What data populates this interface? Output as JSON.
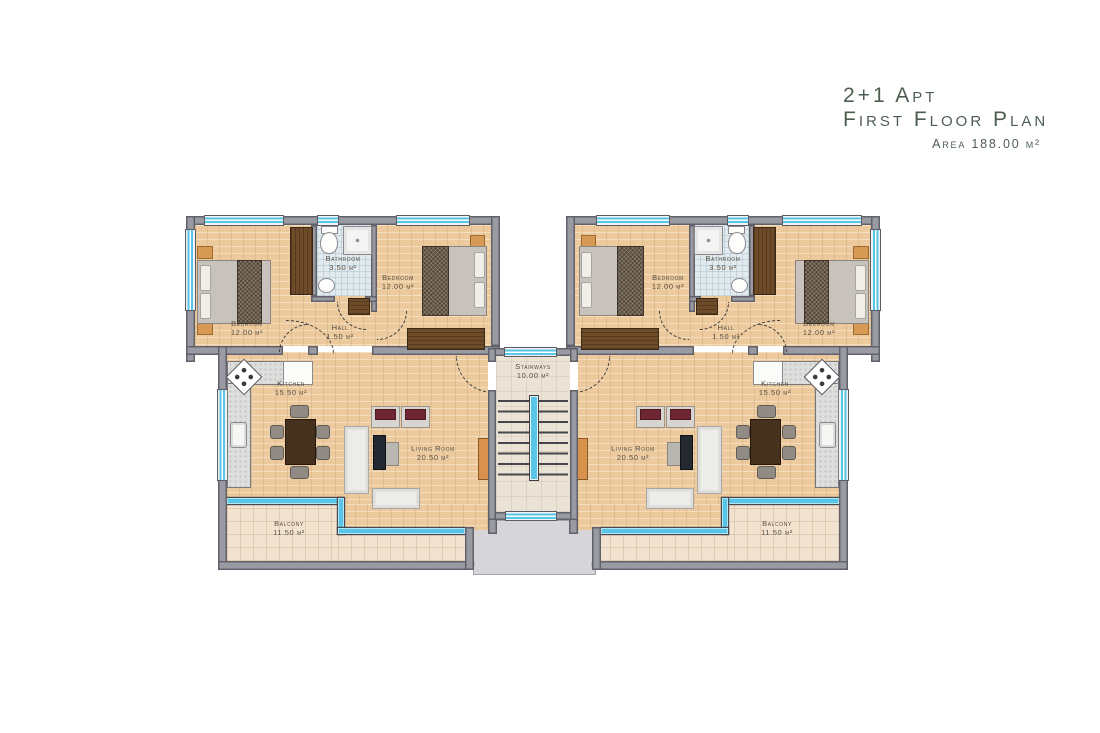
{
  "title": {
    "apt_type": "2+1 Apt",
    "plan_name": "First Floor Plan",
    "area_note": "Area 188.00 m²"
  },
  "rooms": {
    "bedroom": {
      "name": "Bedroom",
      "area": "12.00 m²"
    },
    "bathroom": {
      "name": "Bathroom",
      "area": "3.50 m²"
    },
    "hall": {
      "name": "Hall",
      "area": "1.50 m²"
    },
    "kitchen": {
      "name": "Kitchen",
      "area": "15.50 m²"
    },
    "living_room": {
      "name": "Living Room",
      "area": "20.50 m²"
    },
    "balcony": {
      "name": "Balcony",
      "area": "11.50 m²"
    },
    "stairways": {
      "name": "Stairways",
      "area": "10.00 m²"
    }
  },
  "colors": {
    "title_text": "#4d5e51",
    "label_text": "#574f43",
    "wall_fill": "#9a9aa2",
    "window_glass": "#57c5e8",
    "wood_floor": "#ecca9e",
    "balcony_tile": "#f2e3d1",
    "bathroom_tile": "#e2eaee",
    "door_leaf": "#d9924d"
  }
}
